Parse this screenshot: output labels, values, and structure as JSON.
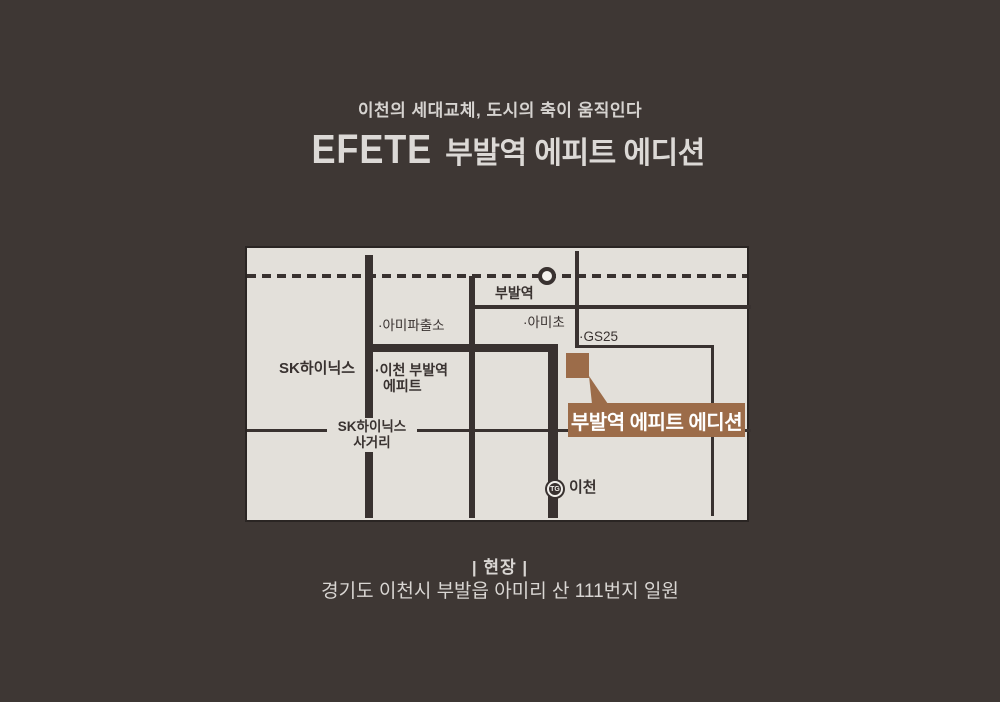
{
  "colors": {
    "page_bg": "#3e3734",
    "light_text": "#d9d6d3",
    "map_bg": "#e3e0da",
    "road": "#393230",
    "accent_brown": "#9c6c49",
    "callout_text": "#ffffff"
  },
  "header": {
    "subtitle": "이천의 세대교체, 도시의 축이 움직인다",
    "title_en": "EFETE",
    "title_ko": "부발역 에피트 에디션"
  },
  "map": {
    "station_label": "부발역",
    "labels": {
      "ami_police": "·아미파출소",
      "ami_elem": "·아미초",
      "gs25": "·GS25",
      "sk_hynix": "SK하이닉스",
      "epit_l1": "·이천 부발역",
      "epit_l2": "에피트",
      "crossroad_l1": "SK하이닉스",
      "crossroad_l2": "사거리",
      "icheon": "이천",
      "tg_badge": "TG"
    },
    "callout_label": "부발역 에피트 에디션"
  },
  "footer": {
    "section_label": "|  현장  |",
    "address": "경기도 이천시 부발읍 아미리 산 111번지 일원"
  }
}
